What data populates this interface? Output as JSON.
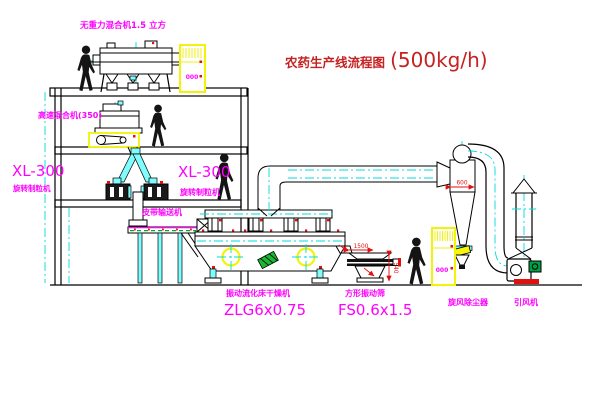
{
  "title": {
    "name": "农药生产线流程图",
    "capacity": "(500kg/h)"
  },
  "equipment": {
    "gravity_mixer": {
      "label": "无重力混合机1.5 立方"
    },
    "high_speed_mixer": {
      "label": "高速混合机(350)"
    },
    "granulator_left": {
      "model": "XL-300",
      "label": "旋转制粒机"
    },
    "granulator_right": {
      "model": "XL-300",
      "label": "旋转制粒机"
    },
    "belt_conveyor": {
      "label": "皮带输送机"
    },
    "fluid_bed_dryer": {
      "label": "振动流化床干燥机",
      "model": "ZLG6x0.75"
    },
    "vibrating_screen": {
      "label": "方形振动筛",
      "model": "FS0.6x1.5",
      "dim_width": "1500",
      "dim_height": "540"
    },
    "cyclone": {
      "label": "旋风除尘器",
      "dim_diameter": "600"
    },
    "draft_fan": {
      "label": "引风机"
    },
    "control_cabinet": {
      "marking": "000"
    }
  },
  "colors": {
    "label_magenta": "#ff00ff",
    "title_red": "#c52222",
    "dimension_red": "#e01010",
    "centerline_cyan": "#00dcdc",
    "cabinet_yellow": "#f2f20a",
    "line_black": "#000000",
    "motor_green": "#00a044"
  }
}
